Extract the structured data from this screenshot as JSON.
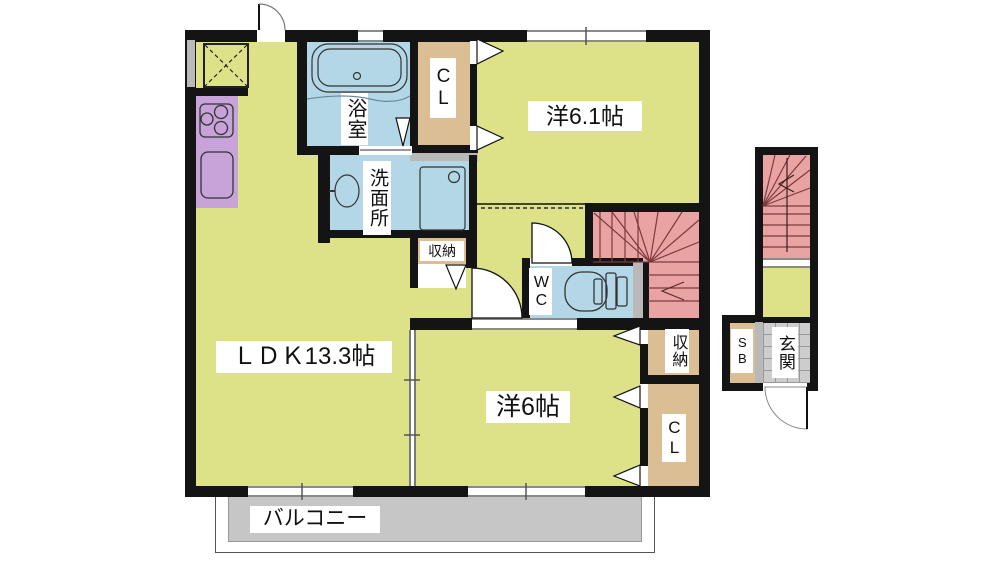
{
  "plan": {
    "type": "floor-plan",
    "labels": {
      "ldk": "ＬＤＫ13.3帖",
      "western_6_1": "洋6.1帖",
      "western_6": "洋6帖",
      "bath": "浴室",
      "washroom": "洗面所",
      "wc": "WC",
      "closet_top": "CL",
      "closet_right": "CL",
      "storage_mid": "収納",
      "storage_right": "収納",
      "shoe_box": "SB",
      "entrance": "玄関",
      "balcony": "バルコニー"
    },
    "colors": {
      "room_yellow": "#dde289",
      "wet_blue": "#b3d7e6",
      "closet_tan": "#dcbe94",
      "kitchen_purple": "#c7a3da",
      "stairs_pink": "#eaa3a3",
      "balcony_gray": "#c6c6c6",
      "tile_gray": "#cdcdcd",
      "wall_black": "#141414",
      "stair_line": "#8a4040"
    }
  }
}
